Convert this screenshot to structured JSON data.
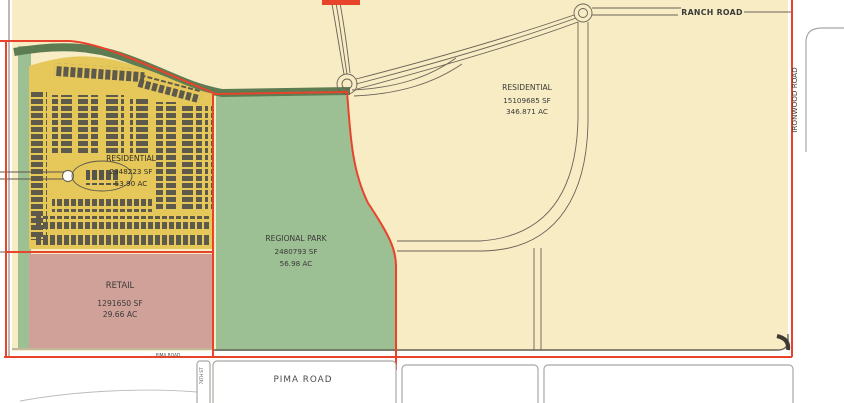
{
  "title": "Land Use Site Plan",
  "colors": {
    "boundary_red": "#e8432b",
    "parcel_tan": "#f7ecc4",
    "park_green": "#9cc094",
    "band_green": "#5e7c52",
    "subdivision_yellow": "#e5c75a",
    "lot_dark": "#56544b",
    "retail_pink": "#cfa199",
    "road_line": "#6b6257",
    "text_dark": "#3a3a36"
  },
  "parcels": {
    "residential_large": {
      "label": "RESIDENTIAL",
      "sf": "15109685 SF",
      "ac": "346.871 AC"
    },
    "residential_subdivision": {
      "label": "RESIDENTIAL",
      "sf": "2348223 SF",
      "ac": "53.90 AC"
    },
    "regional_park": {
      "label": "REGIONAL PARK",
      "sf": "2480793 SF",
      "ac": "56.98 AC"
    },
    "retail": {
      "label": "RETAIL",
      "sf": "1291650 SF",
      "ac": "29.66 AC"
    }
  },
  "roads": {
    "ranch": "RANCH ROAD",
    "ironwood": "IRONWOOD ROAD",
    "pima_small": "PIMA ROAD",
    "pima_main": "PIMA ROAD",
    "side_street": "74TH ST"
  }
}
